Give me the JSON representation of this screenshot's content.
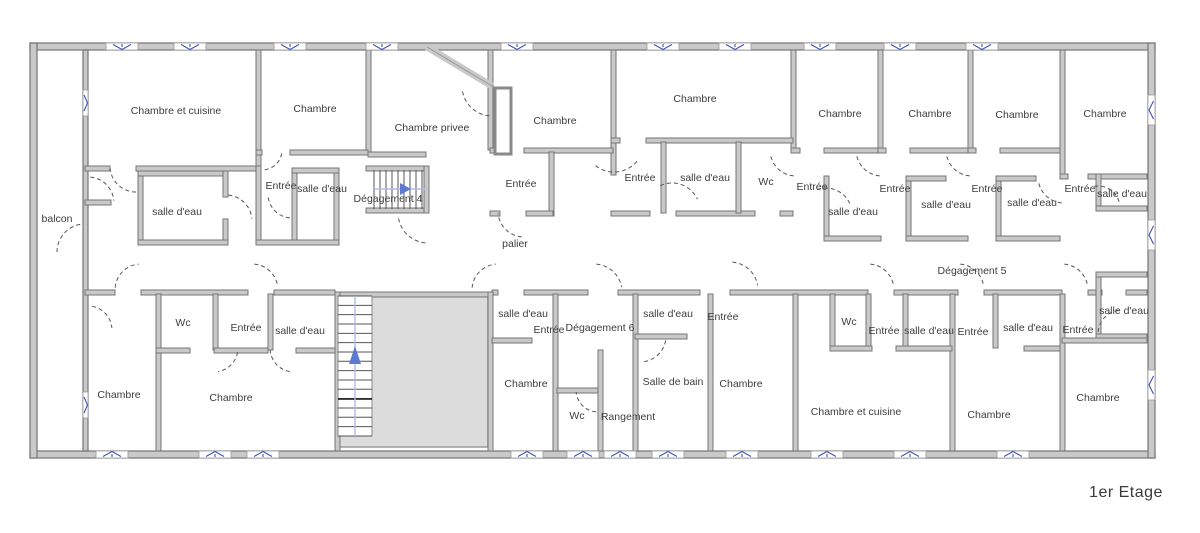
{
  "title": "1er Etage",
  "colors": {
    "wall_fill": "#c9c9c9",
    "wall_stroke": "#757575",
    "window_blue": "#3f51b5",
    "stair_arrow": "#5b7ad0",
    "stair_guide": "#aebce8",
    "door_arc": "#555555",
    "stairwell_fill": "#dcdcdc",
    "label_color": "#3d3d3d"
  },
  "rooms": [
    {
      "label": "Chambre et cuisine",
      "x": 176,
      "y": 114
    },
    {
      "label": "Chambre",
      "x": 315,
      "y": 112
    },
    {
      "label": "Chambre privee",
      "x": 432,
      "y": 131
    },
    {
      "label": "Chambre",
      "x": 555,
      "y": 124
    },
    {
      "label": "Chambre",
      "x": 695,
      "y": 102
    },
    {
      "label": "Chambre",
      "x": 840,
      "y": 117
    },
    {
      "label": "Chambre",
      "x": 930,
      "y": 117
    },
    {
      "label": "Chambre",
      "x": 1017,
      "y": 118
    },
    {
      "label": "Chambre",
      "x": 1105,
      "y": 117
    },
    {
      "label": "balcon",
      "x": 57,
      "y": 222
    },
    {
      "label": "salle d'eau",
      "x": 177,
      "y": 215
    },
    {
      "label": "Entrée",
      "x": 281,
      "y": 189
    },
    {
      "label": "salle d'eau",
      "x": 322,
      "y": 192
    },
    {
      "label": "Dégagement 4",
      "x": 388,
      "y": 202
    },
    {
      "label": "Entrée",
      "x": 521,
      "y": 187
    },
    {
      "label": "Entrée",
      "x": 640,
      "y": 181
    },
    {
      "label": "salle d'eau",
      "x": 705,
      "y": 181
    },
    {
      "label": "Wc",
      "x": 766,
      "y": 185
    },
    {
      "label": "Entrée",
      "x": 812,
      "y": 190
    },
    {
      "label": "salle d'eau",
      "x": 853,
      "y": 215
    },
    {
      "label": "Entrée",
      "x": 895,
      "y": 192
    },
    {
      "label": "salle d'eau",
      "x": 946,
      "y": 208
    },
    {
      "label": "Entrée",
      "x": 987,
      "y": 192
    },
    {
      "label": "salle d'eau",
      "x": 1032,
      "y": 206
    },
    {
      "label": "Entrée",
      "x": 1080,
      "y": 192
    },
    {
      "label": "salle d'eau",
      "x": 1122,
      "y": 197
    },
    {
      "label": "palier",
      "x": 515,
      "y": 247
    },
    {
      "label": "Dégagement 5",
      "x": 972,
      "y": 274
    },
    {
      "label": "Wc",
      "x": 183,
      "y": 326
    },
    {
      "label": "Entrée",
      "x": 246,
      "y": 331
    },
    {
      "label": "salle d'eau",
      "x": 300,
      "y": 334
    },
    {
      "label": "Chambre",
      "x": 119,
      "y": 398
    },
    {
      "label": "Chambre",
      "x": 231,
      "y": 401
    },
    {
      "label": "salle d'eau",
      "x": 523,
      "y": 317
    },
    {
      "label": "Entrée",
      "x": 549,
      "y": 333
    },
    {
      "label": "Dégagement 6",
      "x": 600,
      "y": 331
    },
    {
      "label": "salle d'eau",
      "x": 668,
      "y": 317
    },
    {
      "label": "Entrée",
      "x": 723,
      "y": 320
    },
    {
      "label": "Chambre",
      "x": 526,
      "y": 387
    },
    {
      "label": "Wc",
      "x": 577,
      "y": 419
    },
    {
      "label": "Rangement",
      "x": 628,
      "y": 420
    },
    {
      "label": "Salle de bain",
      "x": 673,
      "y": 385
    },
    {
      "label": "Chambre",
      "x": 741,
      "y": 387
    },
    {
      "label": "Wc",
      "x": 849,
      "y": 325
    },
    {
      "label": "Entrée",
      "x": 884,
      "y": 334
    },
    {
      "label": "salle d'eau",
      "x": 929,
      "y": 334
    },
    {
      "label": "Entrée",
      "x": 973,
      "y": 335
    },
    {
      "label": "salle d'eau",
      "x": 1028,
      "y": 331
    },
    {
      "label": "Entrée",
      "x": 1078,
      "y": 333
    },
    {
      "label": "salle d'eau",
      "x": 1124,
      "y": 314
    },
    {
      "label": "Chambre et cuisine",
      "x": 856,
      "y": 415
    },
    {
      "label": "Chambre",
      "x": 989,
      "y": 418
    },
    {
      "label": "Chambre",
      "x": 1098,
      "y": 401
    }
  ],
  "geometry": {
    "exterior_walls": [
      [
        30,
        43,
        1125,
        7
      ],
      [
        30,
        451,
        1125,
        7
      ],
      [
        30,
        43,
        7,
        415
      ],
      [
        1148,
        43,
        7,
        415
      ],
      [
        83,
        50,
        5,
        401
      ]
    ],
    "interior_walls": [
      [
        256,
        50,
        5,
        118
      ],
      [
        366,
        50,
        5,
        104
      ],
      [
        488,
        50,
        5,
        100
      ],
      [
        611,
        50,
        5,
        125
      ],
      [
        791,
        50,
        5,
        100
      ],
      [
        878,
        50,
        5,
        100
      ],
      [
        968,
        50,
        5,
        100
      ],
      [
        1060,
        50,
        5,
        128
      ],
      [
        85,
        166,
        25,
        5
      ],
      [
        136,
        166,
        124,
        5
      ],
      [
        138,
        171,
        5,
        74
      ],
      [
        138,
        171,
        90,
        5
      ],
      [
        223,
        171,
        5,
        26
      ],
      [
        223,
        219,
        5,
        26
      ],
      [
        138,
        240,
        90,
        5
      ],
      [
        85,
        200,
        26,
        5
      ],
      [
        256,
        150,
        6,
        5
      ],
      [
        290,
        150,
        78,
        5
      ],
      [
        256,
        166,
        5,
        79
      ],
      [
        292,
        168,
        5,
        77
      ],
      [
        334,
        168,
        5,
        77
      ],
      [
        292,
        168,
        47,
        5
      ],
      [
        256,
        240,
        83,
        5
      ],
      [
        368,
        152,
        58,
        5
      ],
      [
        366,
        166,
        62,
        5
      ],
      [
        366,
        208,
        62,
        5
      ],
      [
        424,
        166,
        5,
        47
      ],
      [
        490,
        148,
        8,
        5
      ],
      [
        524,
        148,
        89,
        5
      ],
      [
        549,
        152,
        5,
        64
      ],
      [
        490,
        211,
        10,
        5
      ],
      [
        526,
        211,
        27,
        5
      ],
      [
        611,
        138,
        9,
        5
      ],
      [
        646,
        138,
        147,
        5
      ],
      [
        611,
        211,
        39,
        5
      ],
      [
        676,
        211,
        79,
        5
      ],
      [
        780,
        211,
        13,
        5
      ],
      [
        661,
        142,
        5,
        71
      ],
      [
        736,
        142,
        5,
        71
      ],
      [
        791,
        148,
        9,
        5
      ],
      [
        824,
        148,
        54,
        5
      ],
      [
        824,
        176,
        5,
        62
      ],
      [
        824,
        236,
        57,
        5
      ],
      [
        878,
        148,
        8,
        5
      ],
      [
        910,
        148,
        58,
        5
      ],
      [
        906,
        176,
        5,
        62
      ],
      [
        906,
        176,
        40,
        5
      ],
      [
        906,
        236,
        62,
        5
      ],
      [
        968,
        148,
        8,
        5
      ],
      [
        1000,
        148,
        60,
        5
      ],
      [
        996,
        176,
        5,
        62
      ],
      [
        996,
        176,
        40,
        5
      ],
      [
        996,
        236,
        64,
        5
      ],
      [
        1060,
        174,
        8,
        5
      ],
      [
        1088,
        174,
        59,
        5
      ],
      [
        1096,
        174,
        5,
        37
      ],
      [
        1096,
        206,
        51,
        5
      ],
      [
        85,
        290,
        30,
        5
      ],
      [
        141,
        290,
        107,
        5
      ],
      [
        274,
        290,
        61,
        5
      ],
      [
        492,
        290,
        6,
        5
      ],
      [
        524,
        290,
        64,
        5
      ],
      [
        618,
        290,
        82,
        5
      ],
      [
        730,
        290,
        138,
        5
      ],
      [
        894,
        290,
        64,
        5
      ],
      [
        984,
        290,
        78,
        5
      ],
      [
        1088,
        290,
        14,
        5
      ],
      [
        1126,
        290,
        21,
        5
      ],
      [
        1096,
        272,
        5,
        62
      ],
      [
        1096,
        272,
        51,
        5
      ],
      [
        1096,
        334,
        51,
        5
      ],
      [
        156,
        294,
        5,
        157
      ],
      [
        213,
        294,
        5,
        56
      ],
      [
        268,
        294,
        5,
        56
      ],
      [
        156,
        348,
        34,
        5
      ],
      [
        214,
        348,
        54,
        5
      ],
      [
        296,
        348,
        42,
        5
      ],
      [
        335,
        292,
        157,
        5
      ],
      [
        335,
        292,
        5,
        159
      ],
      [
        488,
        292,
        5,
        159
      ],
      [
        553,
        294,
        5,
        157
      ],
      [
        492,
        338,
        40,
        5
      ],
      [
        633,
        294,
        5,
        157
      ],
      [
        598,
        350,
        5,
        101
      ],
      [
        557,
        388,
        41,
        5
      ],
      [
        708,
        294,
        5,
        157
      ],
      [
        635,
        334,
        52,
        5
      ],
      [
        793,
        294,
        5,
        157
      ],
      [
        830,
        294,
        5,
        54
      ],
      [
        866,
        294,
        5,
        54
      ],
      [
        903,
        294,
        5,
        54
      ],
      [
        950,
        294,
        5,
        157
      ],
      [
        993,
        294,
        5,
        54
      ],
      [
        830,
        346,
        42,
        5
      ],
      [
        896,
        346,
        56,
        5
      ],
      [
        1024,
        346,
        36,
        5
      ],
      [
        1060,
        294,
        5,
        157
      ],
      [
        1062,
        338,
        85,
        5
      ]
    ],
    "boxes": [
      [
        495,
        88,
        16,
        66
      ]
    ],
    "diagonal": {
      "x1": 427,
      "y1": 47,
      "x2": 492,
      "y2": 86
    },
    "windows": {
      "top": [
        122,
        190,
        290,
        382,
        517,
        663,
        735,
        820,
        900,
        982
      ],
      "bottom": [
        112,
        215,
        263,
        527,
        583,
        620,
        668,
        742,
        827,
        910,
        1013
      ],
      "right": [
        110,
        235,
        385
      ],
      "left": [
        103,
        405
      ]
    },
    "doors": [
      [
        136,
        166,
        26,
        90,
        175
      ],
      [
        226,
        221,
        26,
        275,
        355
      ],
      [
        292,
        194,
        24,
        95,
        175
      ],
      [
        262,
        150,
        20,
        10,
        85
      ],
      [
        492,
        86,
        30,
        95,
        170
      ],
      [
        524,
        211,
        26,
        95,
        175
      ],
      [
        614,
        142,
        30,
        40,
        130
      ],
      [
        672,
        211,
        28,
        245,
        335
      ],
      [
        796,
        150,
        26,
        95,
        170
      ],
      [
        826,
        214,
        26,
        250,
        340
      ],
      [
        882,
        150,
        26,
        95,
        170
      ],
      [
        972,
        150,
        26,
        95,
        170
      ],
      [
        1064,
        177,
        26,
        95,
        170
      ],
      [
        1098,
        208,
        22,
        260,
        350
      ],
      [
        88,
        203,
        26,
        275,
        355
      ],
      [
        85,
        252,
        28,
        180,
        265
      ],
      [
        88,
        330,
        24,
        280,
        355
      ],
      [
        428,
        213,
        30,
        95,
        170
      ],
      [
        141,
        290,
        26,
        185,
        265
      ],
      [
        252,
        290,
        26,
        275,
        350
      ],
      [
        498,
        290,
        26,
        185,
        265
      ],
      [
        594,
        292,
        28,
        275,
        350
      ],
      [
        730,
        290,
        28,
        275,
        350
      ],
      [
        868,
        290,
        26,
        275,
        350
      ],
      [
        958,
        290,
        26,
        275,
        350
      ],
      [
        1062,
        290,
        26,
        275,
        350
      ],
      [
        1122,
        334,
        24,
        185,
        265
      ],
      [
        598,
        390,
        22,
        95,
        175
      ],
      [
        640,
        336,
        26,
        10,
        85
      ],
      [
        214,
        348,
        24,
        10,
        80
      ],
      [
        294,
        348,
        24,
        100,
        175
      ]
    ],
    "stairwell": [
      338,
      296,
      150,
      151
    ],
    "main_stairs": {
      "x": 338,
      "y": 296,
      "w": 34,
      "h": 140,
      "step": 9.33,
      "guide_x": 355,
      "dark_tread_y": 399,
      "arrow": [
        [
          349,
          364
        ],
        [
          361,
          364
        ],
        [
          355,
          346
        ]
      ]
    },
    "deg4_stairs": {
      "x": 374,
      "y": 170,
      "w": 48,
      "h": 39,
      "step": 6,
      "guide_y": 189,
      "arrow": [
        [
          400,
          183
        ],
        [
          400,
          195
        ],
        [
          411,
          189
        ]
      ]
    }
  }
}
